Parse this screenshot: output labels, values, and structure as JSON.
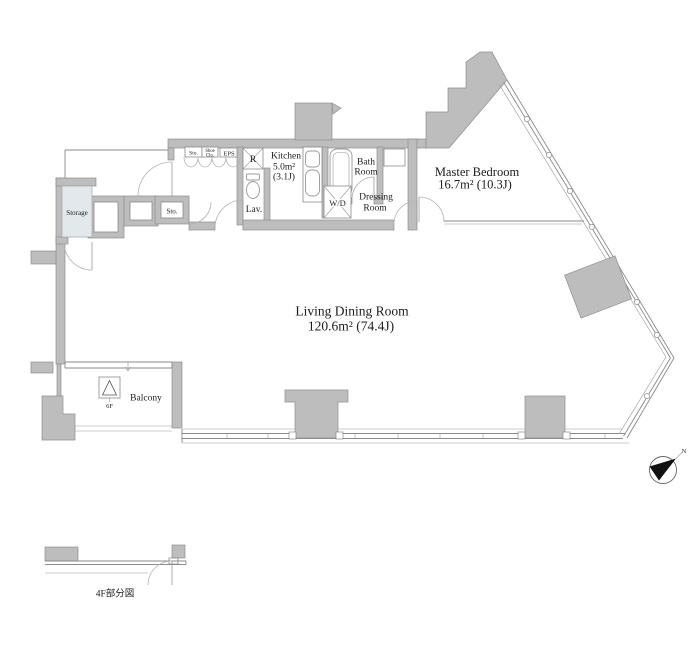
{
  "plan": {
    "rooms": {
      "living": {
        "name": "Living Dining Room",
        "area": "120.6m²  (74.4J)"
      },
      "master": {
        "name": "Master Bedroom",
        "area": "16.7m²  (10.3J)"
      },
      "kitchen": {
        "name": "Kitchen",
        "area": "5.0m²",
        "tatami": "(3.1J)"
      },
      "bath": {
        "line1": "Bath",
        "line2": "Room"
      },
      "dressing": {
        "line1": "Dressing",
        "line2": "Room"
      },
      "lavatory": {
        "name": "Lav."
      },
      "washer_dryer": {
        "name": "W/D"
      },
      "refrigerator": {
        "name": "R"
      },
      "storage": {
        "name": "Storage"
      },
      "storage_hall": {
        "name": "Sto."
      },
      "storage_top": {
        "name": "Sto."
      },
      "shoe_closet": {
        "line1": "Shoe",
        "line2": "Clo."
      },
      "eps": {
        "name": "EPS"
      },
      "balcony": {
        "name": "Balcony",
        "hatch_floor": "6F"
      }
    },
    "annotations": {
      "partial_view": "4F部分図",
      "north": "N"
    },
    "colors": {
      "wall_fill": "#bdbdbd",
      "wall_stroke": "#8f8f8f",
      "storage_fill": "#e2e8ec",
      "line": "#8a8a8a",
      "text": "#1c1c1c"
    }
  }
}
